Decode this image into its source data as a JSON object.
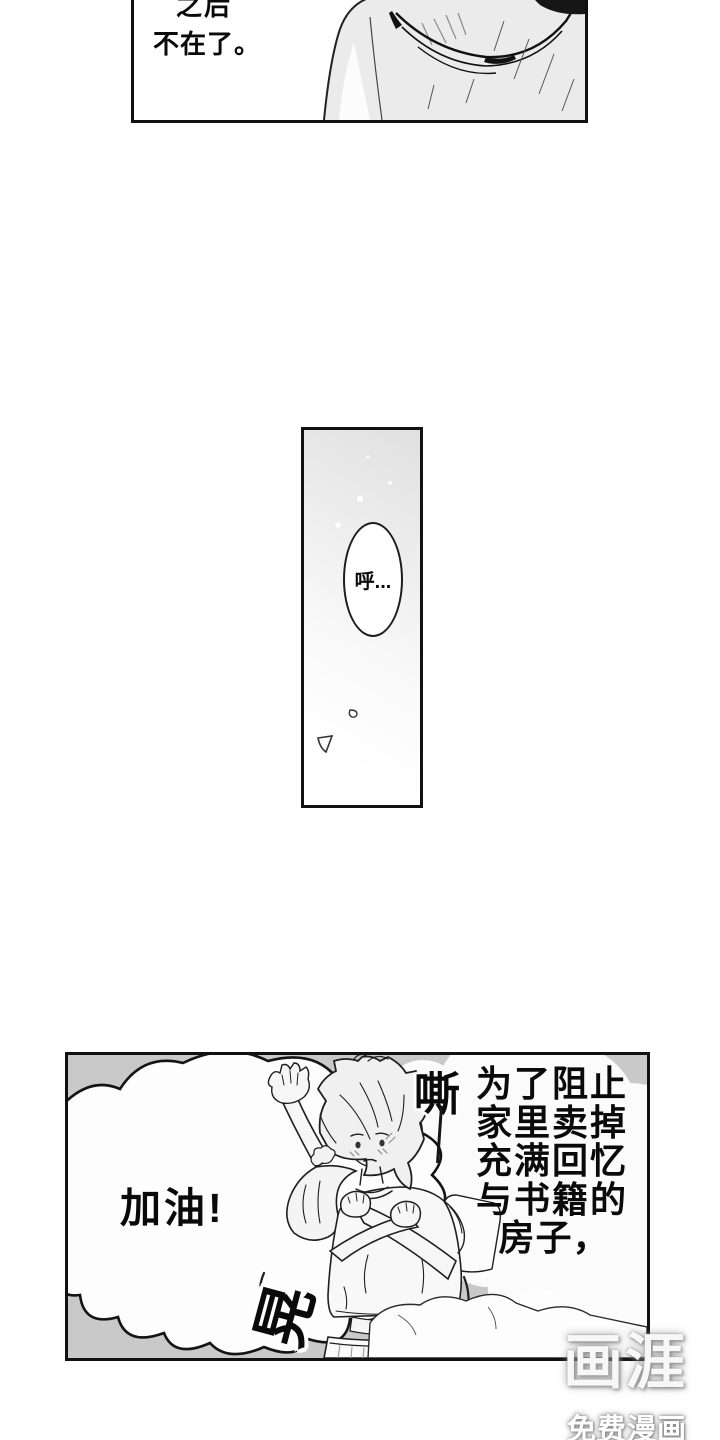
{
  "colors": {
    "panel_border": "#111111",
    "bottom_panel_bg": "#c9c9c9",
    "cloud_white": "#fbfbfb",
    "ink": "#0a0a0a"
  },
  "panel_top": {
    "line1_partial": "之后",
    "line2": "不在了。"
  },
  "panel_middle": {
    "bubble_text": "呼..."
  },
  "panel_bottom": {
    "shout_bubble_text": "加油!",
    "sfx_top": "嘶",
    "sfx_bottom": "晃",
    "narration_lines": [
      "为了阻止",
      "家里卖掉",
      "充满回忆",
      "与书籍的",
      "房子，"
    ]
  },
  "watermark": {
    "logo": "画涯",
    "caption": "免费漫画"
  }
}
